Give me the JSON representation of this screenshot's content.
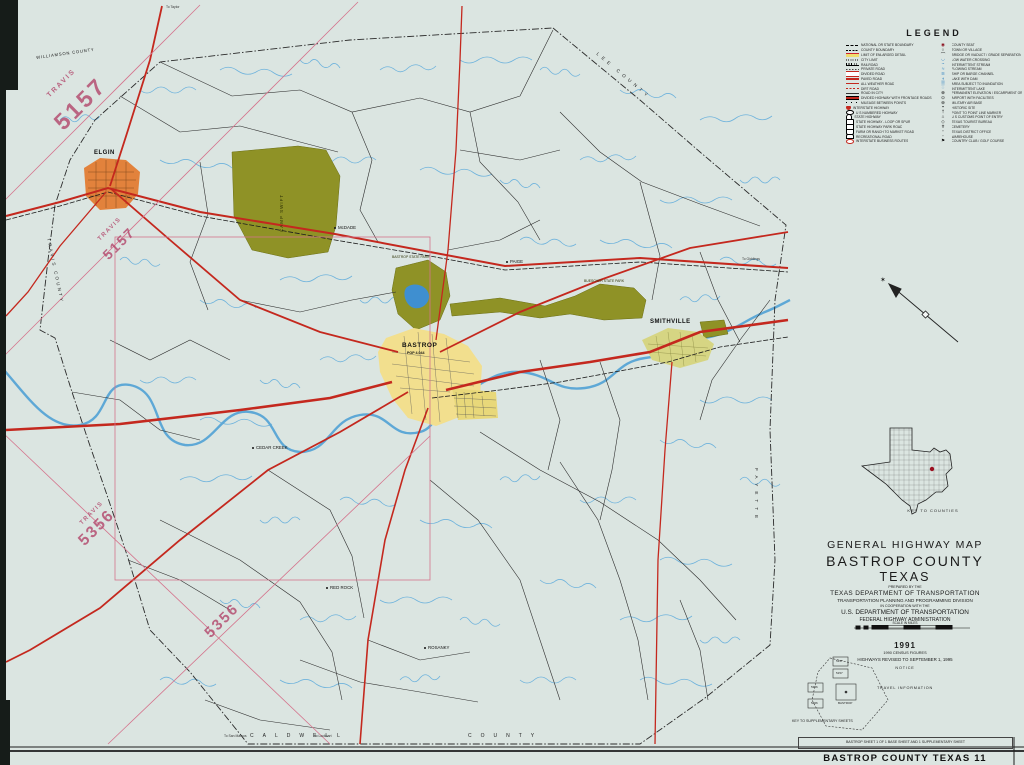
{
  "colors": {
    "paper": "#dbe5e1",
    "highway_red": "#c4281e",
    "stream_blue": "#5ea8d6",
    "park_olive": "#8f9226",
    "lake_blue": "#3f8fd0",
    "city_yellow": "#f2df8e",
    "elgin_orange": "#e2823c",
    "smithville_khaki": "#d6d583",
    "stamp_pink": "#b2486c"
  },
  "legend": {
    "title": "LEGEND",
    "left": [
      {
        "label": "NATIONAL OR STATE BOUNDARY",
        "sw": "bnd"
      },
      {
        "label": "COUNTY BOUNDARY",
        "sw": "cnty"
      },
      {
        "label": "LIMIT OF ENLARGED DETAIL",
        "sw": "limit"
      },
      {
        "label": "CITY LIMIT",
        "sw": "citylim"
      },
      {
        "label": "RAILROAD",
        "sw": "rail"
      },
      {
        "label": "PRIVATE ROAD",
        "sw": "priv"
      },
      {
        "label": "DIVIDED ROAD",
        "sw": "divided"
      },
      {
        "label": "PAVED ROAD",
        "sw": "paved"
      },
      {
        "label": "ALL WEATHER ROAD",
        "sw": "allw"
      },
      {
        "label": "DIRT ROAD",
        "sw": "dirt"
      },
      {
        "label": "ROAD IN CITY",
        "sw": "cityrd"
      },
      {
        "label": "DIVIDED HIGHWAY WITH FRONTAGE ROADS",
        "sw": "frontage"
      },
      {
        "label": "MILEAGE BETWEEN POINTS",
        "sw": "mileage"
      },
      {
        "label": "INTERSTATE HIGHWAY",
        "sw": "sh-i"
      },
      {
        "label": "U S NUMBERED HIGHWAY",
        "sw": "sh-us"
      },
      {
        "label": "STATE HIGHWAY",
        "sw": "sh-st"
      },
      {
        "label": "STATE HIGHWAY - LOOP OR SPUR",
        "sw": "sh-loop"
      },
      {
        "label": "STATE HIGHWAY PARK ROAD",
        "sw": "sh-park"
      },
      {
        "label": "FARM OR RANCH TO MARKET ROAD",
        "sw": "sh-fm"
      },
      {
        "label": "RECREATIONAL ROAD",
        "sw": "sh-rec"
      },
      {
        "label": "INTERSTATE BUSINESS ROUTES",
        "sw": "sh-bus"
      }
    ],
    "right": [
      {
        "label": "COUNTY SEAT",
        "sw": "seat"
      },
      {
        "label": "TOWN OR VILLAGE",
        "sw": "town"
      },
      {
        "label": "BRIDGE OR VIADUCT / GRADE SEPARATION",
        "sw": "bridge"
      },
      {
        "label": "LOW WATER CROSSING",
        "sw": "lwc"
      },
      {
        "label": "INTERMITTENT STREAM",
        "sw": "istream"
      },
      {
        "label": "FLOWING STREAM",
        "sw": "fstream"
      },
      {
        "label": "SHIP OR BARGE CHANNEL",
        "sw": "channel"
      },
      {
        "label": "LAKE WITH DAM",
        "sw": "lake"
      },
      {
        "label": "AREA SUBJECT TO INUNDATION",
        "sw": "inund"
      },
      {
        "label": "INTERMITTENT LAKE",
        "sw": "ilake"
      },
      {
        "label": "PERMANENT ELEVATION / ESCARPMENT OR BLUFF",
        "sw": "elev"
      },
      {
        "label": "AIRPORT WITH FACILITIES",
        "sw": "airport"
      },
      {
        "label": "MILITARY AIR BASE",
        "sw": "military"
      },
      {
        "label": "HISTORIC SITE",
        "sw": "historic"
      },
      {
        "label": "POINT TO POINT LINE MARKER",
        "sw": "marker"
      },
      {
        "label": "U S CUSTOMS POINT OF ENTRY",
        "sw": "customs"
      },
      {
        "label": "TEXAS TOURIST BUREAU",
        "sw": "bureau"
      },
      {
        "label": "CEMETERY",
        "sw": "cemetery"
      },
      {
        "label": "TEXAS DISTRICT OFFICE",
        "sw": "office"
      },
      {
        "label": "WAREHOUSE",
        "sw": "tank"
      },
      {
        "label": "COUNTRY CLUB / GOLF COURSE",
        "sw": "golf"
      }
    ]
  },
  "title_block": {
    "line1": "GENERAL HIGHWAY MAP",
    "line2": "BASTROP COUNTY",
    "line3": "TEXAS",
    "prepared": "PREPARED BY THE",
    "dept": "TEXAS DEPARTMENT OF TRANSPORTATION",
    "division": "TRANSPORTATION PLANNING AND PROGRAMMING DIVISION",
    "coop": "IN COOPERATION WITH THE",
    "usdot": "U.S. DEPARTMENT OF TRANSPORTATION",
    "fhwa": "FEDERAL HIGHWAY ADMINISTRATION",
    "scale_label": "SCALE IN MILES",
    "year": "1991",
    "census": "1990 CENSUS FIGURES",
    "revised": "HIGHWAYS REVISED TO SEPTEMBER 1, 1995"
  },
  "notice": {
    "heading": "NOTICE",
    "lines": [
      "This map has been prepared for internal use within",
      "the Texas Department of Transportation.",
      "Accuracy is limited to the validity of available",
      "data as of dates shown."
    ]
  },
  "travel": {
    "heading": "TRAVEL INFORMATION",
    "lines": [
      "Dial 1-800-452-9292 for travel assistance from a professional",
      "Texas travel counselor, including routing in Texas, emergency",
      "road condition information, and other travel services, or to",
      "register a comment or complaint about department operations.",
      "Copies of this map are available for public use at nominal cost",
      "from the Texas Department of Transportation, 4000 Jackson Avenue,",
      "Austin, Texas 78731, or upon request may be sent to the Budget",
      "and Finance Division, P.O. Box 5051, Austin, Texas 78763-5051."
    ]
  },
  "projection": {
    "lines": [
      "LAMBERT CONFORMAL CONIC PROJECTION - 1927 NORTH AMERICAN DATUM",
      "STANDARD PARALLELS 27°25' AND 34°55'"
    ]
  },
  "key_to_counties": {
    "caption": "KEY TO COUNTIES"
  },
  "key_to_sheets": {
    "caption": "KEY TO SUPPLEMENTARY SHEETS"
  },
  "footer": {
    "sheet_note": "BASTROP SHEET 1 OF 1 BASE SHEET AND 1 SUPPLEMENTARY SHEET",
    "map_title": "BASTROP COUNTY TEXAS 11"
  },
  "map_labels": {
    "stamps": [
      {
        "t": "TRAVIS",
        "x": 46,
        "y": 94,
        "s": 7,
        "r": -45,
        "ls": 2
      },
      {
        "t": "5157",
        "x": 50,
        "y": 118,
        "s": 23,
        "r": -45,
        "ls": 3
      },
      {
        "t": "TRAVIS",
        "x": 97,
        "y": 238,
        "s": 6,
        "r": -45,
        "ls": 1.5
      },
      {
        "t": "5157",
        "x": 100,
        "y": 252,
        "s": 14,
        "r": -45,
        "ls": 2
      },
      {
        "t": "TRAVIS",
        "x": 79,
        "y": 522,
        "s": 6,
        "r": -45,
        "ls": 1.5
      },
      {
        "t": "5356",
        "x": 76,
        "y": 538,
        "s": 16,
        "r": -45,
        "ls": 2
      },
      {
        "t": "5356",
        "x": 202,
        "y": 630,
        "s": 15,
        "r": -45,
        "ls": 2
      }
    ],
    "counties": [
      {
        "t": "WILLIAMSON COUNTY",
        "x": 36,
        "y": 56,
        "s": 4.2,
        "r": -8,
        "ls": 0.8
      },
      {
        "t": "LEE COUNTY",
        "x": 598,
        "y": 52,
        "s": 4.6,
        "r": 40,
        "ls": 4
      },
      {
        "t": "TRAVIS COUNTY",
        "x": 50,
        "y": 238,
        "s": 4.4,
        "r": 78,
        "ls": 2.4
      },
      {
        "t": "CALDWELL",
        "x": 250,
        "y": 734,
        "s": 5,
        "r": 0,
        "ls": 9
      },
      {
        "t": "COUNTY",
        "x": 468,
        "y": 734,
        "s": 5,
        "r": 0,
        "ls": 9
      },
      {
        "t": "FAYETTE",
        "x": 758,
        "y": 468,
        "s": 4.6,
        "r": 90,
        "ls": 5
      }
    ],
    "cities": [
      {
        "t": "ELGIN",
        "x": 94,
        "y": 150,
        "s": 6,
        "r": 0,
        "ls": 0.5
      },
      {
        "t": "BASTROP",
        "x": 402,
        "y": 343,
        "s": 6.5,
        "r": 0,
        "ls": 0.5
      },
      {
        "t": "POP 4,044",
        "x": 407,
        "y": 352,
        "s": 3.6,
        "r": 0,
        "ls": 0
      },
      {
        "t": "SMITHVILLE",
        "x": 650,
        "y": 319,
        "s": 6,
        "r": 0,
        "ls": 0.5
      }
    ],
    "towns": [
      {
        "t": "McDADE",
        "x": 338,
        "y": 226,
        "s": 4.4
      },
      {
        "t": "PAIGE",
        "x": 510,
        "y": 260,
        "s": 4.4
      },
      {
        "t": "CEDAR CREEK",
        "x": 256,
        "y": 446,
        "s": 4.4
      },
      {
        "t": "RED ROCK",
        "x": 330,
        "y": 586,
        "s": 4.4
      },
      {
        "t": "ROSANKY",
        "x": 428,
        "y": 646,
        "s": 4.4
      }
    ],
    "parks": [
      {
        "t": "CAMP SWIFT",
        "x": 280,
        "y": 232,
        "s": 4.5,
        "r": -90,
        "ls": 1
      },
      {
        "t": "BASTROP STATE PARK",
        "x": 392,
        "y": 256,
        "s": 3.4
      },
      {
        "t": "BUESCHER STATE PARK",
        "x": 584,
        "y": 280,
        "s": 3.4
      }
    ],
    "edges": [
      {
        "t": "To Taylor",
        "x": 166,
        "y": 6,
        "s": 3.4
      },
      {
        "t": "To Giddings",
        "x": 742,
        "y": 258,
        "s": 3.4
      },
      {
        "t": "To San Marcos",
        "x": 224,
        "y": 735,
        "s": 3.4
      },
      {
        "t": "To Lockhart",
        "x": 314,
        "y": 735,
        "s": 3.4
      }
    ],
    "sheets": [
      {
        "t": "5157",
        "x": 836,
        "y": 660,
        "s": 3
      },
      {
        "t": "5157",
        "x": 836,
        "y": 672,
        "s": 3
      },
      {
        "t": "5356",
        "x": 811,
        "y": 686,
        "s": 3
      },
      {
        "t": "5456",
        "x": 811,
        "y": 702,
        "s": 3
      },
      {
        "t": "BASTROP",
        "x": 838,
        "y": 702,
        "s": 3
      }
    ]
  }
}
